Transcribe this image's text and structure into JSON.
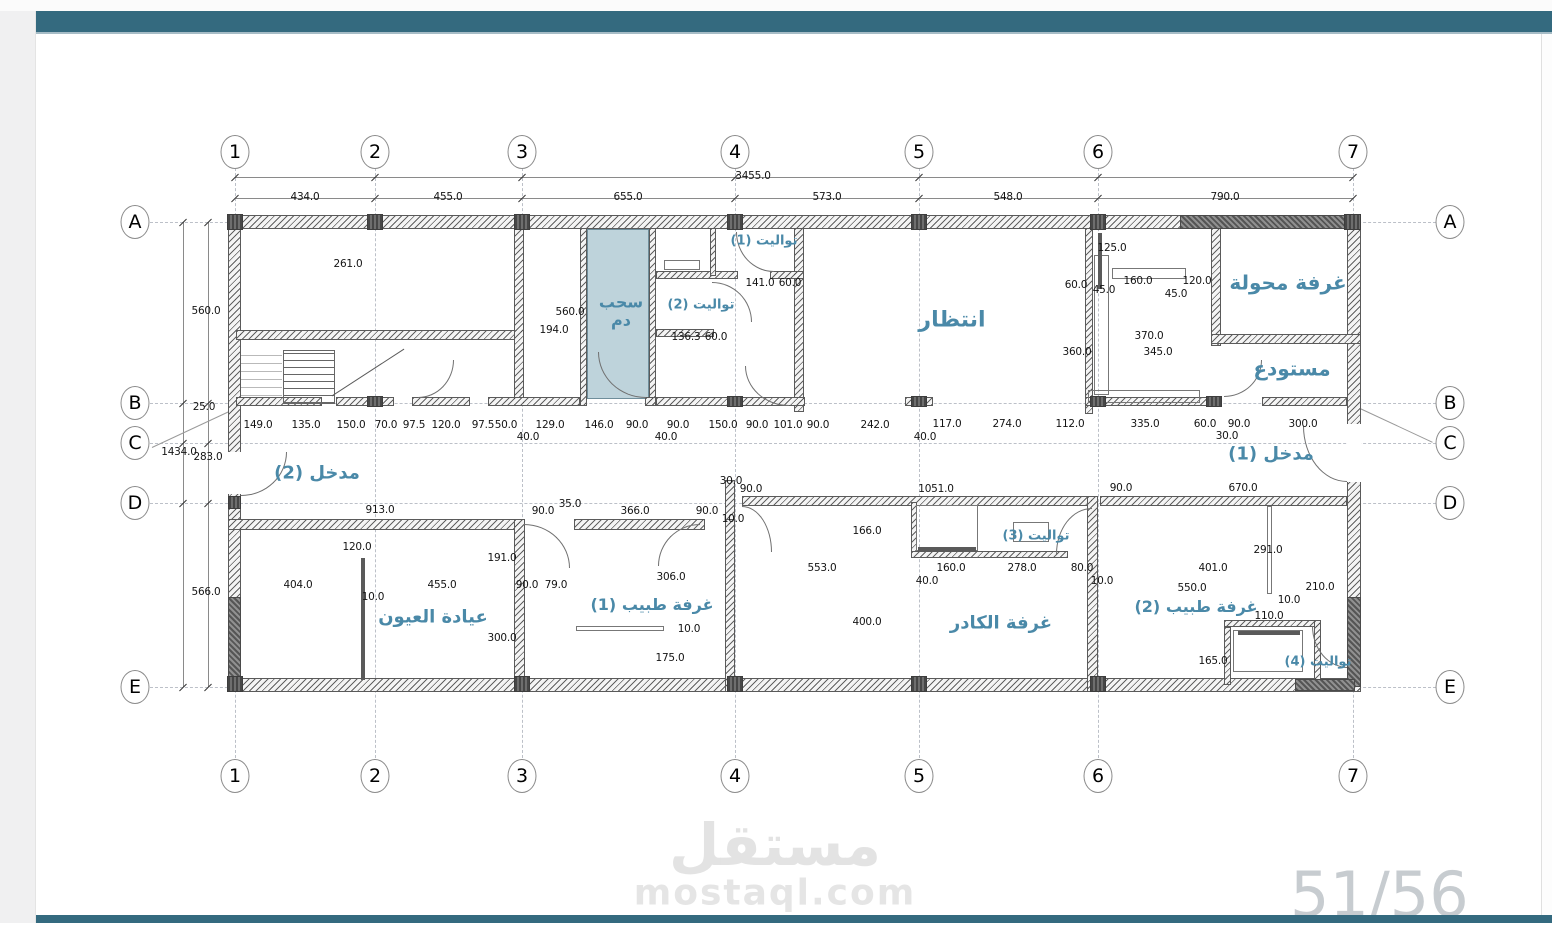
{
  "page": {
    "watermark": {
      "arabic": "مستقل",
      "latin": "mostaql.com"
    },
    "page_number": "51/56",
    "bar_color": "#346a7f",
    "margin_color": "#f0f0f1"
  },
  "accents": {
    "room_label_color": "#4a89a8",
    "highlight_room_fill": "#bed3db",
    "wall_line_color": "#5a5a5a"
  },
  "grid": {
    "columns": [
      {
        "label": "1",
        "x": 235
      },
      {
        "label": "2",
        "x": 375
      },
      {
        "label": "3",
        "x": 522
      },
      {
        "label": "4",
        "x": 735
      },
      {
        "label": "5",
        "x": 919
      },
      {
        "label": "6",
        "x": 1098
      },
      {
        "label": "7",
        "x": 1353
      }
    ],
    "rows": [
      {
        "label": "A",
        "y": 222
      },
      {
        "label": "B",
        "y": 403
      },
      {
        "label": "C",
        "y": 443
      },
      {
        "label": "D",
        "y": 503
      },
      {
        "label": "E",
        "y": 687
      }
    ],
    "top_bubble_y": 152,
    "bottom_bubble_y": 776,
    "left_bubble_x": 135,
    "right_bubble_x": 1450
  },
  "rooms": [
    {
      "id": "waiting",
      "label": "انتظار",
      "x": 952,
      "y": 320,
      "fs": 22
    },
    {
      "id": "transformer",
      "label": "غرفة محولة",
      "x": 1288,
      "y": 283,
      "fs": 20
    },
    {
      "id": "storage",
      "label": "مستودع",
      "x": 1292,
      "y": 369,
      "fs": 20
    },
    {
      "id": "blood-draw",
      "label": "سحب\nدم",
      "x": 621,
      "y": 312,
      "fs": 16
    },
    {
      "id": "toilet-1",
      "label": "تواليت (1)",
      "x": 764,
      "y": 242,
      "fs": 13
    },
    {
      "id": "toilet-2",
      "label": "تواليت (2)",
      "x": 701,
      "y": 306,
      "fs": 13
    },
    {
      "id": "toilet-3",
      "label": "تواليت (3)",
      "x": 1036,
      "y": 537,
      "fs": 13
    },
    {
      "id": "toilet-4",
      "label": "تواليت (4)",
      "x": 1318,
      "y": 663,
      "fs": 13
    },
    {
      "id": "entrance-2",
      "label": "مدخل (2)",
      "x": 317,
      "y": 474,
      "fs": 18
    },
    {
      "id": "entrance-1",
      "label": "مدخل (1)",
      "x": 1271,
      "y": 455,
      "fs": 18
    },
    {
      "id": "eye-clinic",
      "label": "عيادة العيون",
      "x": 433,
      "y": 618,
      "fs": 18
    },
    {
      "id": "doctor-1",
      "label": "غرفة طبيب (1)",
      "x": 652,
      "y": 605,
      "fs": 16
    },
    {
      "id": "staff-room",
      "label": "غرفة الكادر",
      "x": 1001,
      "y": 624,
      "fs": 18
    },
    {
      "id": "doctor-2",
      "label": "غرفة طبيب (2)",
      "x": 1196,
      "y": 607,
      "fs": 16
    }
  ],
  "dimensions": [
    {
      "t": "3455.0",
      "x": 753,
      "y": 176
    },
    {
      "t": "434.0",
      "x": 305,
      "y": 197
    },
    {
      "t": "455.0",
      "x": 448,
      "y": 197
    },
    {
      "t": "655.0",
      "x": 628,
      "y": 197
    },
    {
      "t": "573.0",
      "x": 827,
      "y": 197
    },
    {
      "t": "548.0",
      "x": 1008,
      "y": 197
    },
    {
      "t": "790.0",
      "x": 1225,
      "y": 197
    },
    {
      "t": "560.0",
      "x": 206,
      "y": 311
    },
    {
      "t": "25.0",
      "x": 204,
      "y": 407
    },
    {
      "t": "1434.0",
      "x": 179,
      "y": 452
    },
    {
      "t": "283.0",
      "x": 208,
      "y": 457
    },
    {
      "t": "566.0",
      "x": 206,
      "y": 592
    },
    {
      "t": "261.0",
      "x": 348,
      "y": 264
    },
    {
      "t": "560.0",
      "x": 570,
      "y": 312
    },
    {
      "t": "194.0",
      "x": 554,
      "y": 330
    },
    {
      "t": "136.3",
      "x": 686,
      "y": 337
    },
    {
      "t": "60.0",
      "x": 716,
      "y": 337
    },
    {
      "t": "141.0",
      "x": 760,
      "y": 283
    },
    {
      "t": "60.0",
      "x": 790,
      "y": 283
    },
    {
      "t": "125.0",
      "x": 1112,
      "y": 248
    },
    {
      "t": "60.0",
      "x": 1076,
      "y": 285
    },
    {
      "t": "45.0",
      "x": 1104,
      "y": 290
    },
    {
      "t": "160.0",
      "x": 1138,
      "y": 281
    },
    {
      "t": "120.0",
      "x": 1197,
      "y": 281
    },
    {
      "t": "45.0",
      "x": 1176,
      "y": 294
    },
    {
      "t": "370.0",
      "x": 1149,
      "y": 336
    },
    {
      "t": "345.0",
      "x": 1158,
      "y": 352
    },
    {
      "t": "360.0",
      "x": 1077,
      "y": 352
    },
    {
      "t": "149.0",
      "x": 258,
      "y": 425
    },
    {
      "t": "135.0",
      "x": 306,
      "y": 425
    },
    {
      "t": "150.0",
      "x": 351,
      "y": 425
    },
    {
      "t": "70.0",
      "x": 386,
      "y": 425
    },
    {
      "t": "97.5",
      "x": 414,
      "y": 425
    },
    {
      "t": "120.0",
      "x": 446,
      "y": 425
    },
    {
      "t": "97.5",
      "x": 483,
      "y": 425
    },
    {
      "t": "50.0",
      "x": 506,
      "y": 425
    },
    {
      "t": "129.0",
      "x": 550,
      "y": 425
    },
    {
      "t": "40.0",
      "x": 528,
      "y": 437
    },
    {
      "t": "146.0",
      "x": 599,
      "y": 425
    },
    {
      "t": "90.0",
      "x": 637,
      "y": 425
    },
    {
      "t": "40.0",
      "x": 666,
      "y": 437
    },
    {
      "t": "90.0",
      "x": 678,
      "y": 425
    },
    {
      "t": "150.0",
      "x": 723,
      "y": 425
    },
    {
      "t": "90.0",
      "x": 757,
      "y": 425
    },
    {
      "t": "101.0",
      "x": 788,
      "y": 425
    },
    {
      "t": "90.0",
      "x": 818,
      "y": 425
    },
    {
      "t": "242.0",
      "x": 875,
      "y": 425
    },
    {
      "t": "117.0",
      "x": 947,
      "y": 424
    },
    {
      "t": "40.0",
      "x": 925,
      "y": 437
    },
    {
      "t": "274.0",
      "x": 1007,
      "y": 424
    },
    {
      "t": "112.0",
      "x": 1070,
      "y": 424
    },
    {
      "t": "335.0",
      "x": 1145,
      "y": 424
    },
    {
      "t": "60.0",
      "x": 1205,
      "y": 424
    },
    {
      "t": "90.0",
      "x": 1239,
      "y": 424
    },
    {
      "t": "30.0",
      "x": 1227,
      "y": 436
    },
    {
      "t": "300.0",
      "x": 1303,
      "y": 424
    },
    {
      "t": "913.0",
      "x": 380,
      "y": 510
    },
    {
      "t": "90.0",
      "x": 543,
      "y": 511
    },
    {
      "t": "35.0",
      "x": 570,
      "y": 504
    },
    {
      "t": "366.0",
      "x": 635,
      "y": 511
    },
    {
      "t": "90.0",
      "x": 707,
      "y": 511
    },
    {
      "t": "10.0",
      "x": 733,
      "y": 519
    },
    {
      "t": "30.0",
      "x": 731,
      "y": 481
    },
    {
      "t": "90.0",
      "x": 751,
      "y": 489
    },
    {
      "t": "1051.0",
      "x": 936,
      "y": 489
    },
    {
      "t": "90.0",
      "x": 1121,
      "y": 488
    },
    {
      "t": "670.0",
      "x": 1243,
      "y": 488
    },
    {
      "t": "120.0",
      "x": 357,
      "y": 547
    },
    {
      "t": "191.0",
      "x": 502,
      "y": 558
    },
    {
      "t": "404.0",
      "x": 298,
      "y": 585
    },
    {
      "t": "10.0",
      "x": 373,
      "y": 597
    },
    {
      "t": "455.0",
      "x": 442,
      "y": 585
    },
    {
      "t": "90.0",
      "x": 527,
      "y": 585
    },
    {
      "t": "79.0",
      "x": 556,
      "y": 585
    },
    {
      "t": "300.0",
      "x": 502,
      "y": 638
    },
    {
      "t": "306.0",
      "x": 671,
      "y": 577
    },
    {
      "t": "10.0",
      "x": 689,
      "y": 629
    },
    {
      "t": "175.0",
      "x": 670,
      "y": 658
    },
    {
      "t": "166.0",
      "x": 867,
      "y": 531
    },
    {
      "t": "553.0",
      "x": 822,
      "y": 568
    },
    {
      "t": "160.0",
      "x": 951,
      "y": 568
    },
    {
      "t": "278.0",
      "x": 1022,
      "y": 568
    },
    {
      "t": "80.0",
      "x": 1082,
      "y": 568
    },
    {
      "t": "40.0",
      "x": 927,
      "y": 581
    },
    {
      "t": "10.0",
      "x": 1102,
      "y": 581
    },
    {
      "t": "400.0",
      "x": 867,
      "y": 622
    },
    {
      "t": "291.0",
      "x": 1268,
      "y": 550
    },
    {
      "t": "401.0",
      "x": 1213,
      "y": 568
    },
    {
      "t": "550.0",
      "x": 1192,
      "y": 588
    },
    {
      "t": "210.0",
      "x": 1320,
      "y": 587
    },
    {
      "t": "10.0",
      "x": 1289,
      "y": 600
    },
    {
      "t": "110.0",
      "x": 1269,
      "y": 616
    },
    {
      "t": "165.0",
      "x": 1213,
      "y": 661
    }
  ]
}
